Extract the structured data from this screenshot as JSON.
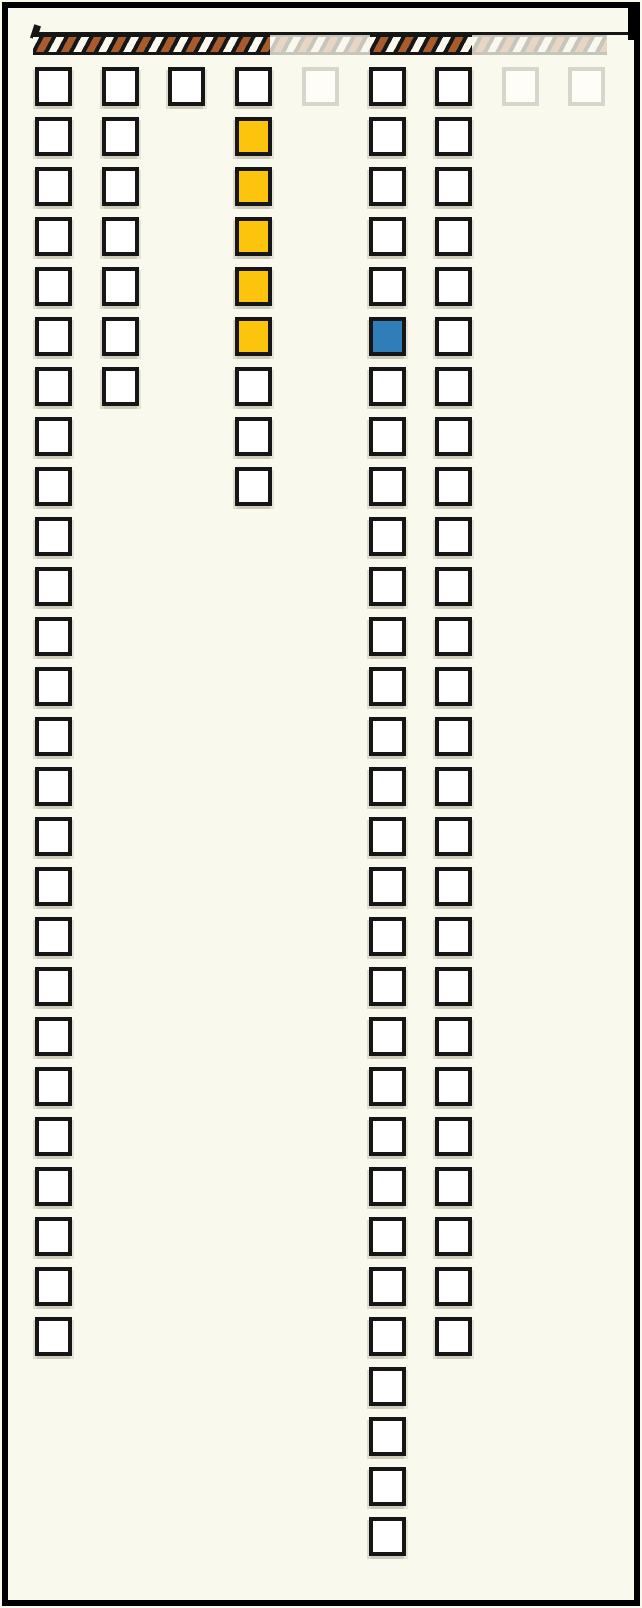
{
  "canvas": {
    "width": 642,
    "height": 1608,
    "background_color": "#FAF9EE",
    "frame_color": "#000000",
    "ink_color": "#161616"
  },
  "progress_ribbon": {
    "x": 33,
    "y": 34,
    "height": 21,
    "stripe_white": "#FAF8EF",
    "stripe_brown": "#A85C2E",
    "segments": [
      {
        "state": "active",
        "x": 33,
        "width": 237
      },
      {
        "state": "faded",
        "x": 270,
        "width": 100
      },
      {
        "state": "active",
        "x": 370,
        "width": 102
      },
      {
        "state": "faded",
        "x": 472,
        "width": 135
      }
    ]
  },
  "grid": {
    "origin_y": 67,
    "row_spacing": 50,
    "square_outer_width": 37,
    "square_outer_height": 39,
    "colors": {
      "default_fill": "#FFFFFF",
      "yellow_fill": "#FDC40E",
      "blue_fill": "#2F7EB9",
      "border": "#161616",
      "faded_border": "#D8D6CA"
    },
    "total_squares": 102,
    "columns": [
      {
        "id": 1,
        "x": 35,
        "squares": 26,
        "state": "active",
        "yellow_rows": [],
        "blue_rows": []
      },
      {
        "id": 2,
        "x": 102,
        "squares": 7,
        "state": "active",
        "yellow_rows": [],
        "blue_rows": []
      },
      {
        "id": 3,
        "x": 168,
        "squares": 1,
        "state": "active",
        "yellow_rows": [],
        "blue_rows": []
      },
      {
        "id": 4,
        "x": 235,
        "squares": 9,
        "state": "active",
        "yellow_rows": [
          2,
          3,
          4,
          5,
          6
        ],
        "blue_rows": []
      },
      {
        "id": 5,
        "x": 302,
        "squares": 1,
        "state": "faded",
        "yellow_rows": [],
        "blue_rows": []
      },
      {
        "id": 6,
        "x": 369,
        "squares": 30,
        "state": "active",
        "yellow_rows": [],
        "blue_rows": [
          6
        ]
      },
      {
        "id": 7,
        "x": 435,
        "squares": 26,
        "state": "active",
        "yellow_rows": [],
        "blue_rows": []
      },
      {
        "id": 8,
        "x": 502,
        "squares": 1,
        "state": "faded",
        "yellow_rows": [],
        "blue_rows": []
      },
      {
        "id": 9,
        "x": 568,
        "squares": 1,
        "state": "faded",
        "yellow_rows": [],
        "blue_rows": []
      }
    ]
  }
}
